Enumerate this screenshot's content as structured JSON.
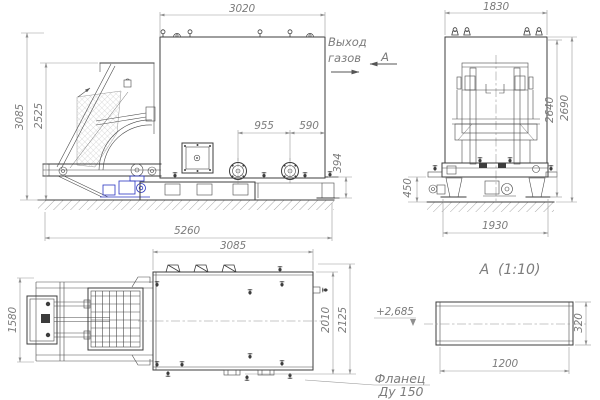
{
  "drawing": {
    "front_view": {
      "dim_width_top": "3020",
      "dim_height_total": "3085",
      "dim_height_hopper": "2525",
      "dim_flange_spacing": "955",
      "dim_flange_to_edge": "590",
      "dim_ledge_height": "394",
      "dim_length_overall": "5260",
      "gas_outlet_line1": "Выход",
      "gas_outlet_line2": "газов",
      "view_arrow_label": "А"
    },
    "side_view": {
      "dim_width_top": "1830",
      "dim_height_body": "2640",
      "dim_height_overall": "2690",
      "dim_base_height": "450",
      "dim_base_width": "1930"
    },
    "plan_view": {
      "dim_width": "3085",
      "dim_depth_left": "1580",
      "dim_depth_body": "2010",
      "dim_depth_overall": "2125"
    },
    "detail_view": {
      "title": "А  (1:10)",
      "dim_length": "1200",
      "dim_height": "320",
      "level_mark": "+2,685",
      "callout_line1": "Фланец",
      "callout_line2": "Ду 150"
    },
    "colors": {
      "line": "#3c3c3c",
      "dimension": "#979797",
      "text": "#7c7c7c",
      "drive_accent": "#2a35c0"
    }
  }
}
